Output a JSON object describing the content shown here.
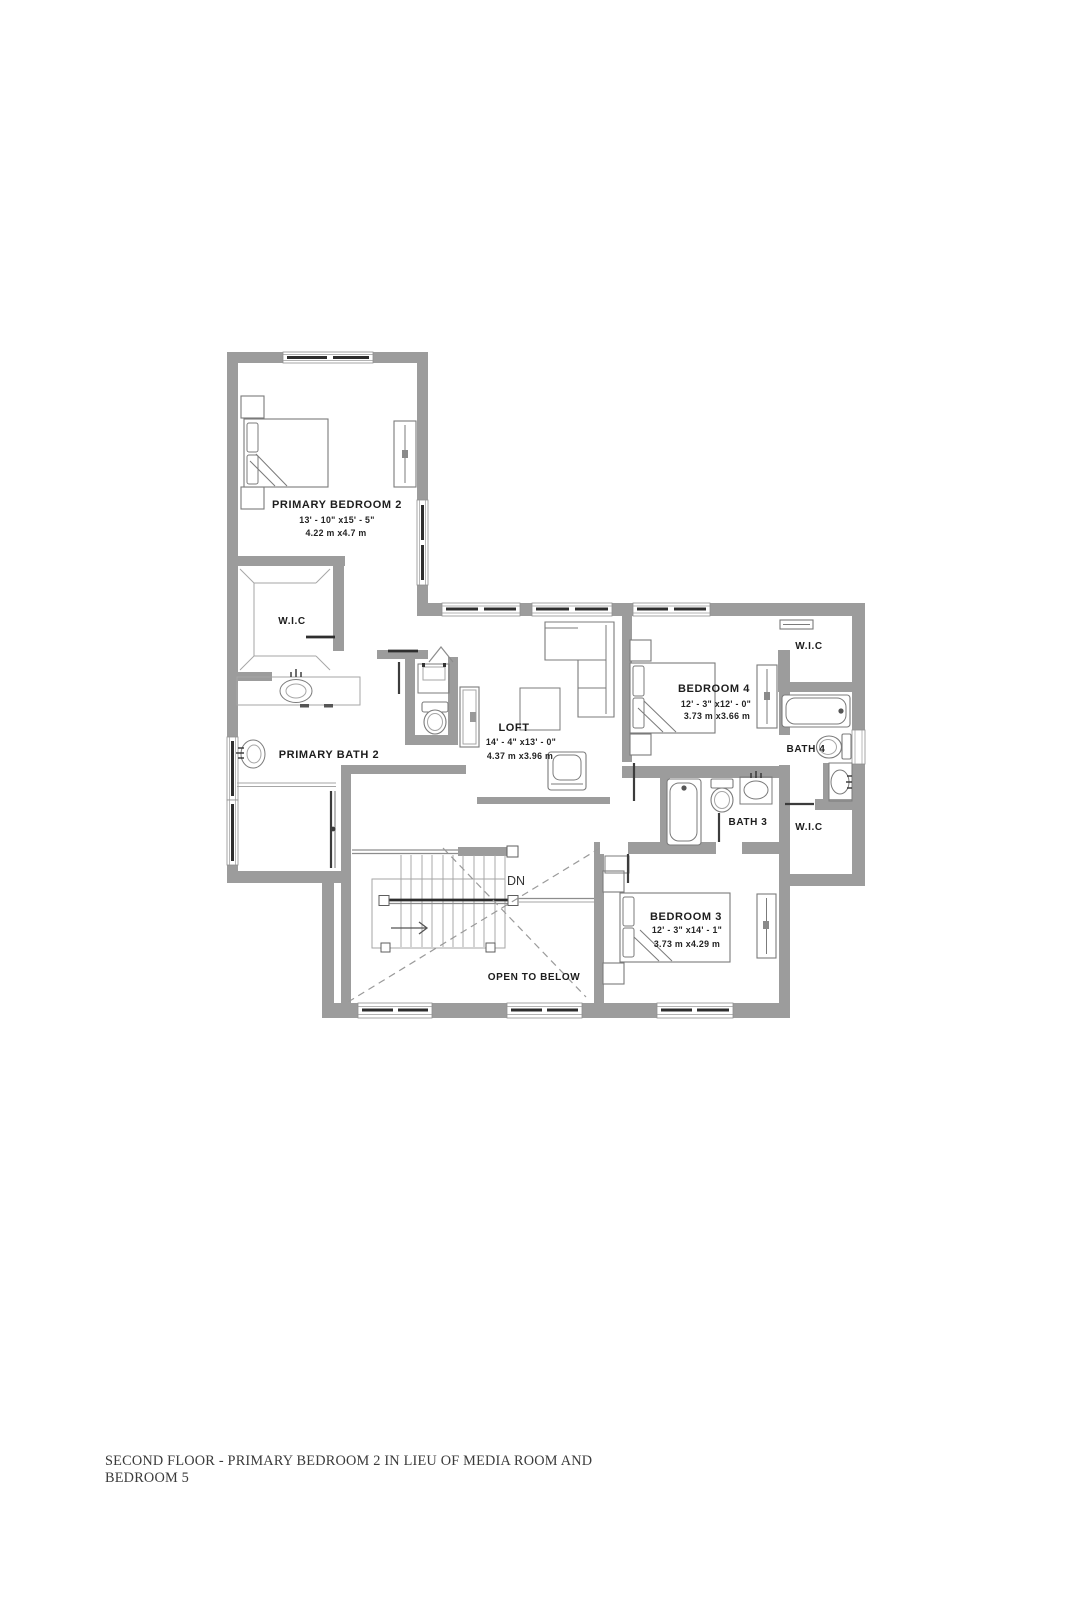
{
  "page": {
    "caption": {
      "line1": "SECOND FLOOR - PRIMARY BEDROOM 2 IN LIEU OF MEDIA ROOM AND",
      "line2": "BEDROOM 5"
    }
  },
  "floorplan": {
    "annotations": {
      "stairs": "DN",
      "open": "OPEN TO BELOW"
    },
    "rooms": [
      {
        "name": "PRIMARY BEDROOM 2",
        "dim_ft": "13' - 10\" x15' - 5\"",
        "dim_m": "4.22 m x4.7 m"
      },
      {
        "name": "W.I.C"
      },
      {
        "name": "PRIMARY BATH 2"
      },
      {
        "name": "LOFT",
        "dim_ft": "14' - 4\" x13' - 0\"",
        "dim_m": "4.37 m x3.96 m"
      },
      {
        "name": "BEDROOM 4",
        "dim_ft": "12' - 3\" x12' - 0\"",
        "dim_m": "3.73 m x3.66 m"
      },
      {
        "name": "W.I.C"
      },
      {
        "name": "BATH 4"
      },
      {
        "name": "BATH 3"
      },
      {
        "name": "W.I.C"
      },
      {
        "name": "BEDROOM 3",
        "dim_ft": "12' - 3\" x14' - 1\"",
        "dim_m": "3.73 m x4.29 m"
      }
    ],
    "colors": {
      "wall": "#9c9c9c",
      "fixture": "#7b7b7b",
      "thin": "#a6a6a6",
      "dark": "#2e2e2e",
      "text": "#1d1d1d",
      "caption": "#3a3a3a"
    }
  }
}
